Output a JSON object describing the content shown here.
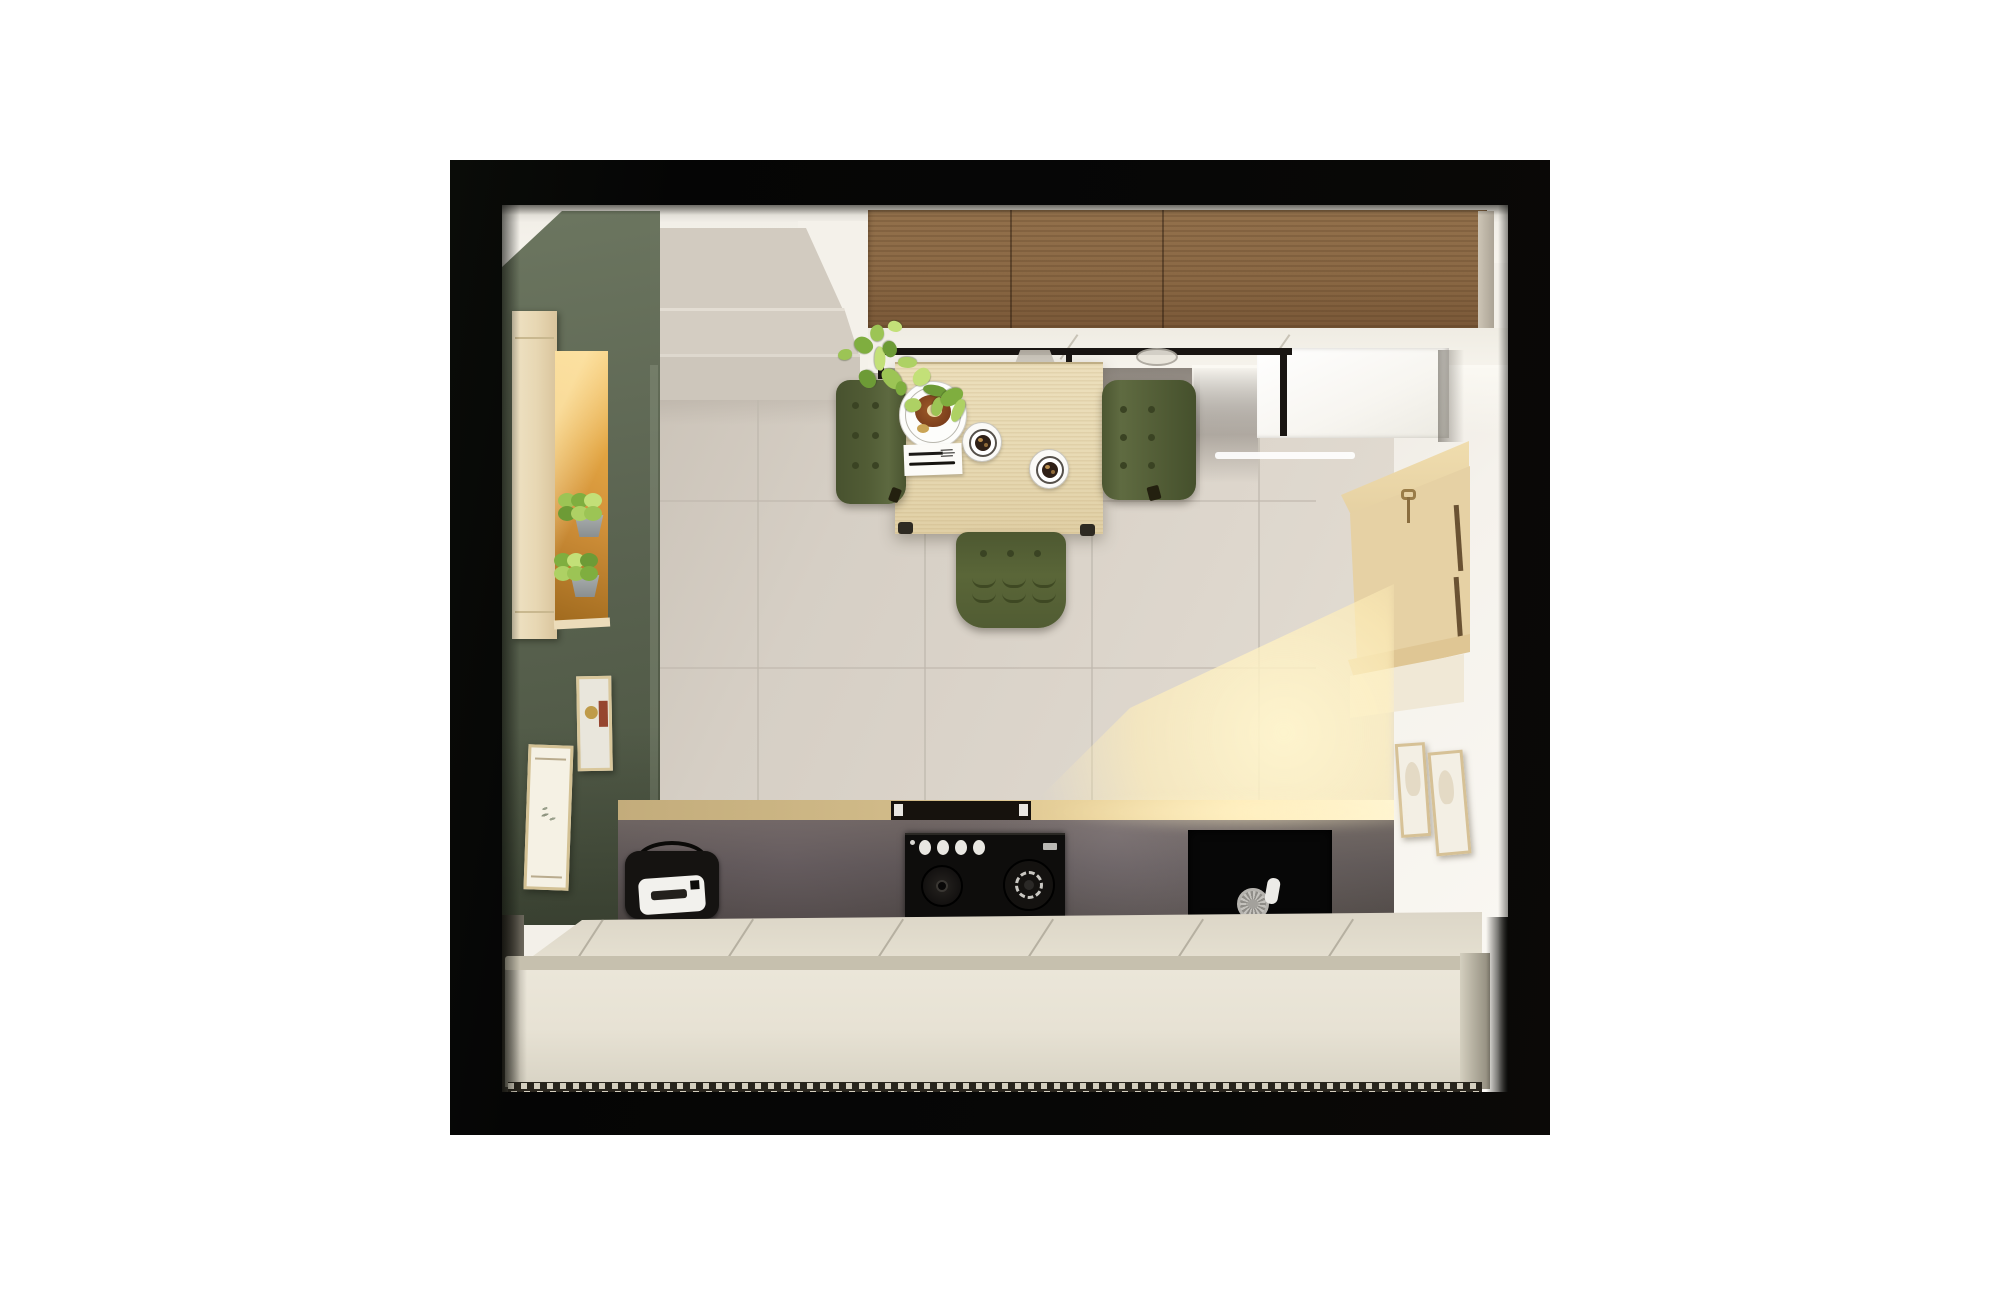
{
  "meta": {
    "title": "Top-down 3D interior render of a compact kitchen",
    "view": "top-down orthographic-style visualization inside a black frame on a white page"
  },
  "palette": {
    "page": "#ffffff",
    "frame": "#060606",
    "ceiling": "#f2efe8",
    "white_warm": "#f3f0e9",
    "wall_green": "#5b6451",
    "wall_green_light": "#6c7660",
    "wall_green_dark": "#49523f",
    "tile": "#d6cfc5",
    "grout": "#bfb8ad",
    "chimney": "#d2cbc0",
    "walnut": "#8a6844",
    "table_wood": "#e8dab4",
    "chair_green": "#515c35",
    "chair_green_dark": "#3a4323",
    "counter_dark": "#575050",
    "counter_wood": "#d2bc8a",
    "sunlight": "#ffeab2",
    "cabinet_cream": "#e7e2d4",
    "cabinet_edge": "#c6c0ae",
    "cabinet_top": "#dcd6c7",
    "vent_bg": "#28241c",
    "vent_dash": "#d5cfbf",
    "nook_wood": "#e5d0a2",
    "fridge": "#f7f5f0",
    "niche_amber": "#d2913a",
    "cooktop_knob": "#e9e7e2",
    "plant_colors": [
      "#9cc455",
      "#7fae3f",
      "#c3e078",
      "#6d9b36",
      "#aed164"
    ],
    "art_red": "#96452f",
    "art_gold": "#bf9b4a"
  },
  "scene": {
    "walls": {
      "accent_wall": "olive green, left side",
      "art_left_count": 2,
      "art_right_count": 2
    },
    "floor": {
      "material": "large beige stone tiles",
      "grout_lines_vertical": 4,
      "grout_lines_horizontal": 2,
      "sunlight_patch": true
    },
    "dining": {
      "table": "light wood rectangular table",
      "chairs": {
        "count": 3,
        "color": "olive green upholstered",
        "tuft_cols": 2,
        "tuft_rows": 3,
        "bottom_dots": 3,
        "bottom_arcs": 6
      },
      "tableware": {
        "dinner_plates": 1,
        "coffee_cups": 2,
        "napkin_with_cutlery": 1,
        "cutlery": [
          "fork",
          "knife"
        ]
      },
      "pendant_shades": 2,
      "vine_plant_leaves": 16
    },
    "kitchen_run": {
      "upper_cabinet": "dark walnut wall cabinet",
      "countertop": "dark stone worktop",
      "cooktop": {
        "knobs": 4,
        "burners": 2
      },
      "sink": {
        "basin": "black single basin",
        "drain": 1,
        "tap_handle": 1
      },
      "toaster": 1,
      "extractor_vent": 1
    },
    "tall_units": {
      "fridge_white": 1,
      "wood_key_nook": 1,
      "keys_on_hook": 1
    },
    "niche_shelf": {
      "herb_pots": 2,
      "backlit": true
    },
    "base_cabinets": {
      "finish": "cream handleless",
      "door_seams": 6,
      "vent_grille": true
    }
  }
}
